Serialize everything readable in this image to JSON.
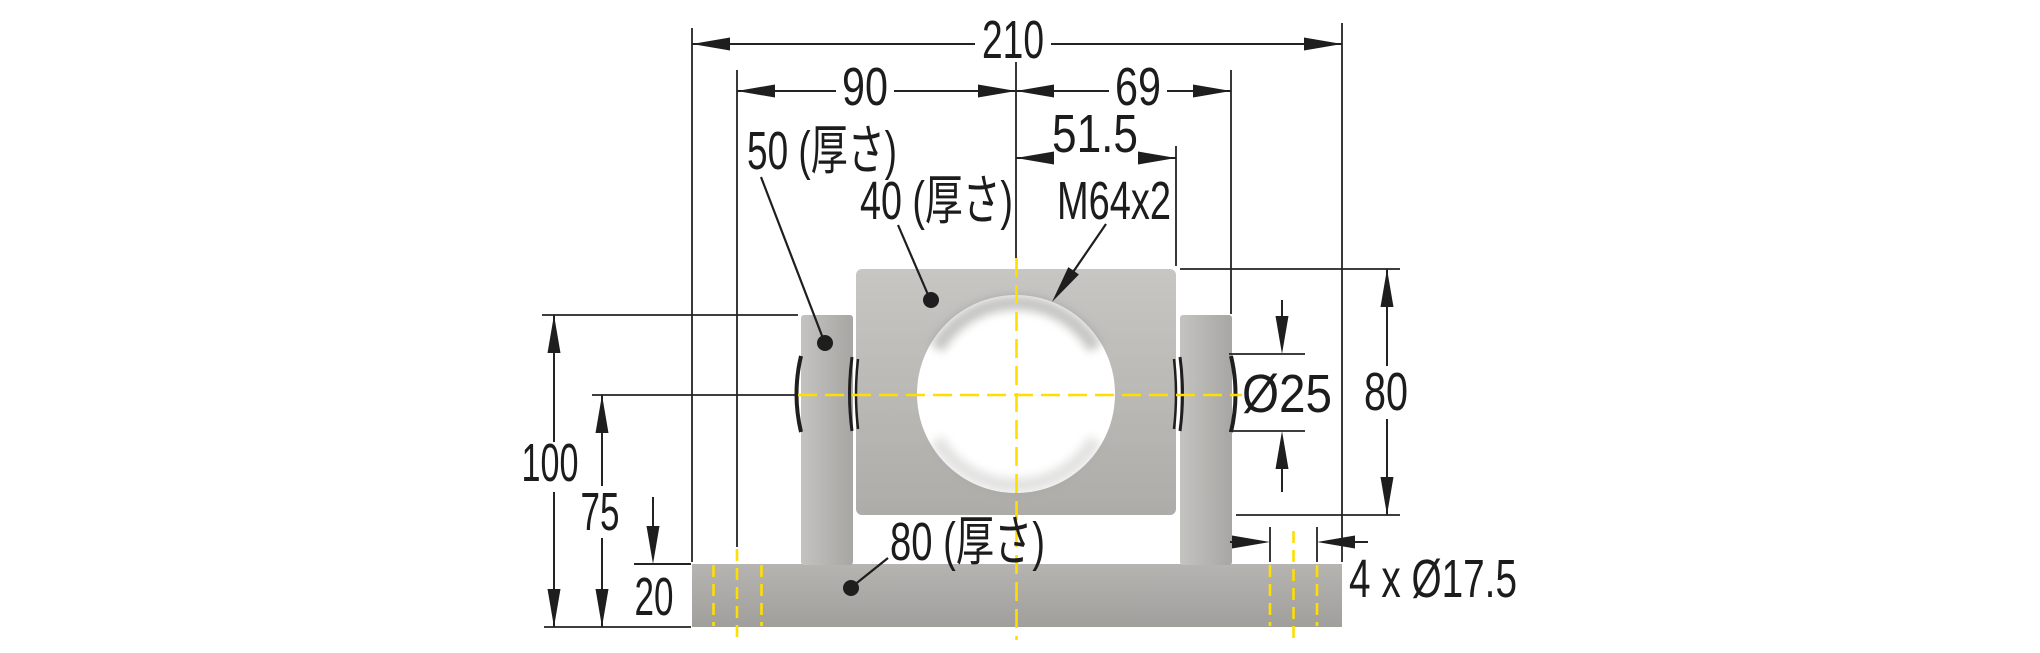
{
  "drawing": {
    "dims": {
      "overall_width": "210",
      "hole_to_center": "90",
      "center_to_lug_face": "69",
      "center_to_body_edge": "51.5",
      "lug_top_height": "100",
      "axis_height": "75",
      "base_height": "20",
      "body_height": "80",
      "pin_diameter": "Ø25",
      "mount_holes": "4 x Ø17.5",
      "thread_callout": "M64x2",
      "lug_thickness": "50 (厚さ)",
      "body_thickness": "40 (厚さ)",
      "base_depth": "80 (厚さ)"
    },
    "colors": {
      "centerline_yellow": "#ffde00",
      "part_gray": "#b4b3b0",
      "line_black": "#232323",
      "background": "#ffffff"
    }
  }
}
